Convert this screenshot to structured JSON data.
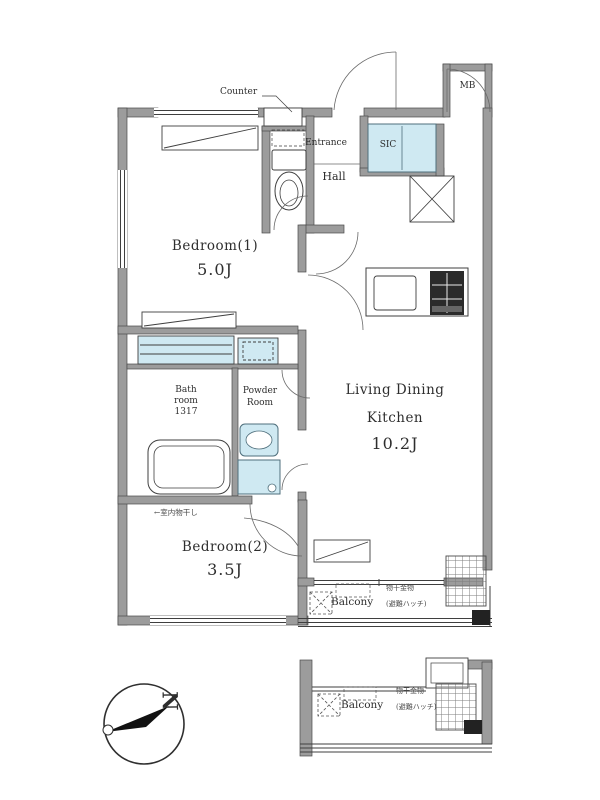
{
  "labels": {
    "counter": "Counter",
    "entrance": "Entrance",
    "hall": "Hall",
    "sic": "SIC",
    "mb": "MB",
    "bedroom1_name": "Bedroom(1)",
    "bedroom1_size": "5.0J",
    "bedroom2_name": "Bedroom(2)",
    "bedroom2_size": "3.5J",
    "bedroom2_note": "←室内物干し",
    "ldk_line1": "Living Dining",
    "ldk_line2": "Kitchen",
    "ldk_size": "10.2J",
    "bath_line1": "Bath",
    "bath_line2": "room",
    "bath_line3": "1317",
    "powder_line1": "Powder",
    "powder_line2": "Room",
    "balcony_main": "Balcony",
    "balcony_main_note": "物干金物",
    "balcony_main_bracket": "(避難ハッチ)",
    "balcony_lower": "Balcony",
    "balcony_lower_note": "物干金物",
    "balcony_lower_bracket": "(避難ハッチ)",
    "compass_n": "N"
  },
  "colors": {
    "wall_gray": "#9c9c9c",
    "accent_blue": "#cfe9f2",
    "line_dark": "#3f3f3f",
    "stove_black": "#2b2b2b"
  },
  "icons": {
    "compass": "north-arrow-circle",
    "toilet": "toilet-bowl",
    "bathtub": "bathtub",
    "kitchen": "sink-and-stove",
    "fridge_space": "x-cross-box",
    "escape_hatch": "dashed-x-hatch"
  }
}
